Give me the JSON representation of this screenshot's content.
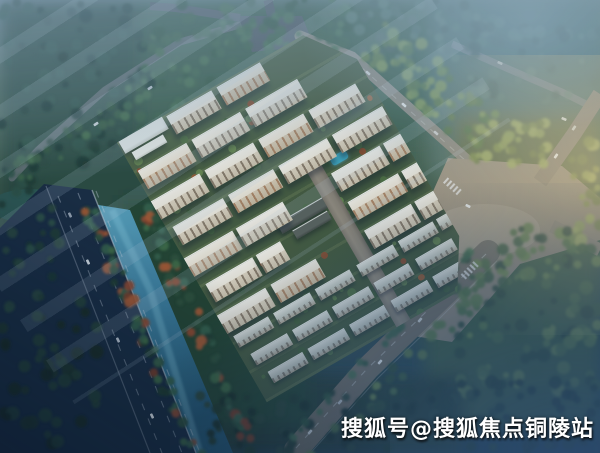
{
  "watermark": {
    "text": "搜狐号@搜狐焦点铜陵站"
  },
  "scene": {
    "subject": "aerial-rendering-residential-complex",
    "colors": {
      "haze_blue": "#94aec4",
      "forest_dark": "#27473a",
      "forest_warm": "#7c8c48",
      "canal_water": "#3f7f9f",
      "pool_water": "#3fa8c0",
      "highway_asphalt": "#17293f",
      "road_tan": "#968b7a",
      "road_grey": "#756e62",
      "building_roof": "#f5f2ea",
      "building_facade": "#ddd3c0",
      "window_dark": "#52402e",
      "autumn_tree_red": "#94462a",
      "complex_green_a": "#4e6342",
      "complex_green_b": "#3a5036",
      "warm_glow": "#f2d69e",
      "night_blue": "#2c4a6e"
    }
  }
}
